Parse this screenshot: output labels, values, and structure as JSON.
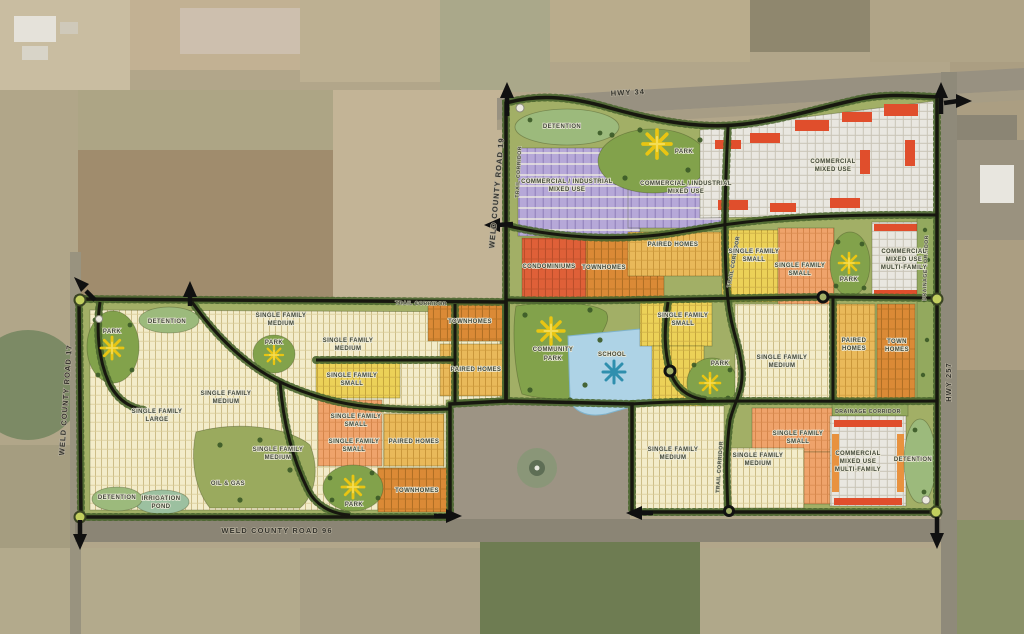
{
  "map_type": "land-use-master-plan",
  "roads": {
    "hwy34": "HWY 34",
    "hwy257": "HWY 257",
    "wcr17": "WELD COUNTY ROAD 17",
    "wcr19": "WELD COUNTY ROAD 19",
    "wcr96": "WELD COUNTY ROAD 96",
    "trail_c1": "TRAIL CORRIDOR",
    "trail_c2": "TRAIL CORRIDOR",
    "trail_c3": "TRAIL CORRIDOR",
    "trail_c4": "TRAIL CORRIDOR",
    "drain_h": "DRAINAGE CORRIDOR",
    "drain_v": "DRAINAGE CORRIDOR"
  },
  "zones": {
    "det_n": "DETENTION",
    "park_n": "PARK",
    "ci1_l1": "COMMERCIAL / INDUSTRIAL",
    "ci1_l2": "MIXED USE",
    "ci2_l1": "COMMERCIAL / INDUSTRIAL",
    "ci2_l2": "MIXED USE",
    "cmu_l1": "COMMERCIAL",
    "cmu_l2": "MIXED USE",
    "condo": "CONDOMINIUMS",
    "town_n": "TOWNHOMES",
    "paired_n": "PAIRED HOMES",
    "sfs1_l1": "SINGLE FAMILY",
    "sfs1_l2": "SMALL",
    "sfs2_l1": "SINGLE FAMILY",
    "sfs2_l2": "SMALL",
    "cmumf1_l1": "COMMERCIAL",
    "cmumf1_l2": "MIXED USE",
    "cmumf1_l3": "MULTI-FAMILY",
    "park_ne": "PARK",
    "compark_l1": "COMMUNITY",
    "compark_l2": "PARK",
    "school": "SCHOOL",
    "sfs3_l1": "SINGLE FAMILY",
    "sfs3_l2": "SMALL",
    "park_mid": "PARK",
    "sfm1_l1": "SINGLE FAMILY",
    "sfm1_l2": "MEDIUM",
    "paired_mid_l1": "PAIRED",
    "paired_mid_l2": "HOMES",
    "town_mid_l1": "TOWN",
    "town_mid_l2": "HOMES",
    "sfm2_l1": "SINGLE FAMILY",
    "sfm2_l2": "MEDIUM",
    "sfs4_l1": "SINGLE FAMILY",
    "sfs4_l2": "SMALL",
    "sfm3_l1": "SINGLE FAMILY",
    "sfm3_l2": "MEDIUM",
    "cmumf2_l1": "COMMERCIAL",
    "cmumf2_l2": "MIXED USE",
    "cmumf2_l3": "MULTI-FAMILY",
    "det_se": "DETENTION",
    "park_w": "PARK",
    "det_nw": "DETENTION",
    "sfm4_l1": "SINGLE FAMILY",
    "sfm4_l2": "MEDIUM",
    "park_c": "PARK",
    "sfm5_l1": "SINGLE FAMILY",
    "sfm5_l2": "MEDIUM",
    "sfs5_l1": "SINGLE FAMILY",
    "sfs5_l2": "SMALL",
    "town_ne": "TOWNHOMES",
    "sfm6_l1": "SINGLE FAMILY",
    "sfm6_l2": "MEDIUM",
    "sfl_l1": "SINGLE FAMILY",
    "sfl_l2": "LARGE",
    "sfs6_l1": "SINGLE FAMILY",
    "sfs6_l2": "SMALL",
    "sfs7_l1": "SINGLE FAMILY",
    "sfs7_l2": "SMALL",
    "paired_w1": "PAIRED HOMES",
    "paired_w2": "PAIRED HOMES",
    "town_sw": "TOWNHOMES",
    "park_s": "PARK",
    "oilgas": "OIL & GAS",
    "irr_l1": "IRRIGATION",
    "irr_l2": "POND",
    "det_sw": "DETENTION",
    "sfm7_l1": "SINGLE FAMILY",
    "sfm7_l2": "MEDIUM"
  },
  "icons": {
    "park": "sun-starburst-icon",
    "school": "snowflake-icon",
    "gateway": "gateway-circle-marker",
    "roundabout": "roundabout-circle",
    "continuation": "road-arrow"
  },
  "colors": {
    "plan_base_green": "#a2af66",
    "park_green": "#82a24b",
    "detention_green": "#9cba7c",
    "single_family_large_medium": "#f3ecca",
    "single_family_small_yellow": "#ecd158",
    "single_family_small_orange": "#efa36b",
    "paired_homes_gold": "#e9b95a",
    "townhomes_orange": "#db8a36",
    "condominiums_red": "#df6038",
    "commercial_industrial_lavender": "#b6a8d8",
    "commercial_parking_white": "#e9e7e0",
    "commercial_building_red": "#e04e2c",
    "school_pond_blue": "#aed3e6",
    "sun_yellow": "#e9c512",
    "snowflake_blue": "#2f8fae",
    "road_black": "#17170f",
    "aerial_tan": "#b2a68a"
  }
}
